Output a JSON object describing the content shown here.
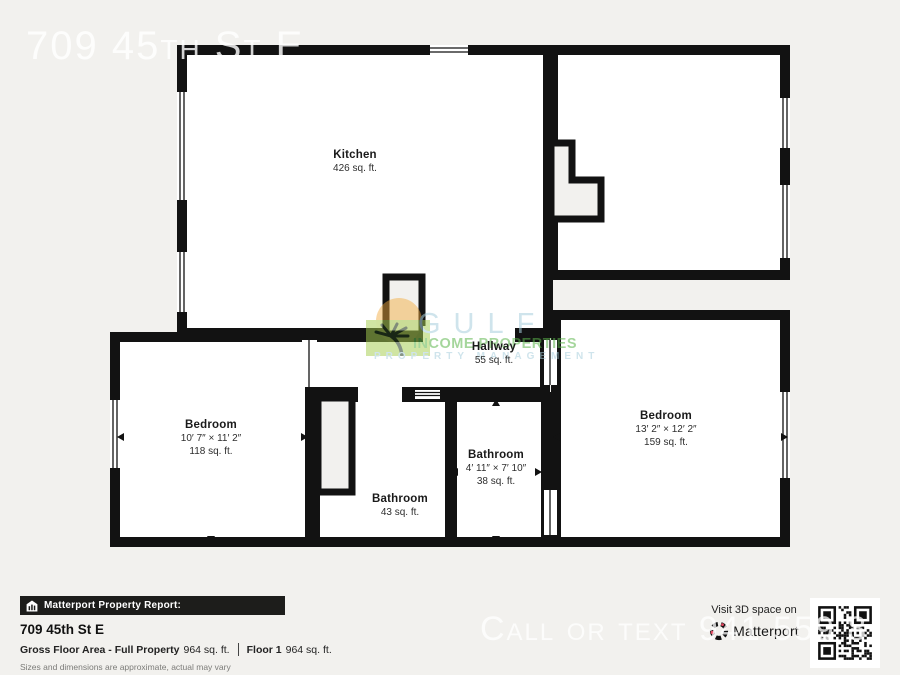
{
  "watermarks": {
    "top": "709 45th St E",
    "bottom": "Call or text 941 559 8",
    "logo": {
      "word1": "GULF",
      "word2": "INCOME PROPERTIES",
      "word3": "PROPERTY MANAGEMENT"
    }
  },
  "plan": {
    "rooms": [
      {
        "id": "kitchen",
        "name": "Kitchen",
        "area": "426 sq. ft."
      },
      {
        "id": "hallway",
        "name": "Hallway",
        "area": "55 sq. ft."
      },
      {
        "id": "bedroom-left",
        "name": "Bedroom",
        "dims": "10′ 7″ × 11′ 2″",
        "area": "118 sq. ft."
      },
      {
        "id": "bathroom-left",
        "name": "Bathroom",
        "area": "43 sq. ft."
      },
      {
        "id": "bathroom-mid",
        "name": "Bathroom",
        "dims": "4′ 11″ × 7′ 10″",
        "area": "38 sq. ft."
      },
      {
        "id": "bedroom-right",
        "name": "Bedroom",
        "dims": "13′ 2″ × 12′ 2″",
        "area": "159 sq. ft."
      }
    ]
  },
  "report": {
    "bar_title": "Matterport Property Report:",
    "address": "709 45th St E",
    "gross_label": "Gross Floor Area - Full Property",
    "gross_value": "964 sq. ft.",
    "floor_label": "Floor 1",
    "floor_value": "964 sq. ft.",
    "disclaimer": "Sizes and dimensions are approximate, actual may vary"
  },
  "footer_right": {
    "visit": "Visit 3D space on",
    "brand": "Matterport"
  },
  "colors": {
    "bg": "#f2f1ee",
    "wall": "#121212",
    "bar_bg": "#1d1d1b",
    "logo_blue": "#a8cfdd",
    "logo_green": "#5cb64c",
    "sun_orange": "#f2a93b",
    "palm_green": "#a5cd50",
    "mp_red": "#e0475f"
  }
}
